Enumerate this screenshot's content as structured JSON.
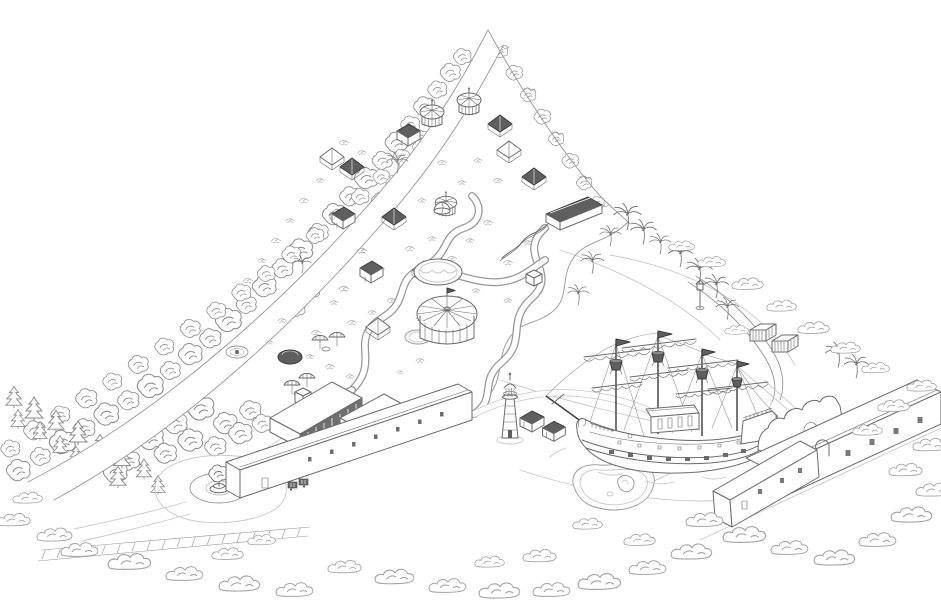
{
  "meta": {
    "description": "Hand-drawn isometric pen-and-ink map of a seaside amusement park with wooded mountain ridge, pirate ship, lighthouse and entrance plaza",
    "style": "monochrome line art",
    "background": "#ffffff"
  },
  "palette": {
    "ink_dark": "#3b3b3b",
    "ink": "#6b6b6b",
    "ink_light": "#979797",
    "ink_faint": "#c8c8c8",
    "paper": "#ffffff",
    "fill_dark": "#5f5f5f"
  },
  "landmarks": [
    {
      "id": "mountain-ridge-road",
      "center": [
        260,
        260
      ]
    },
    {
      "id": "amusement-park-grounds",
      "center": [
        400,
        240
      ]
    },
    {
      "id": "grand-carousel",
      "center": [
        447,
        330
      ]
    },
    {
      "id": "wave-pool",
      "center": [
        438,
        272
      ]
    },
    {
      "id": "water-slide-pavilion",
      "center": [
        575,
        215
      ]
    },
    {
      "id": "round-pavilions",
      "center": [
        450,
        145
      ]
    },
    {
      "id": "beach-lagoon",
      "center": [
        650,
        330
      ]
    },
    {
      "id": "pirate-ship",
      "center": [
        672,
        410
      ]
    },
    {
      "id": "lighthouse",
      "center": [
        510,
        410
      ]
    },
    {
      "id": "beach-huts",
      "center": [
        545,
        430
      ]
    },
    {
      "id": "storage-containers",
      "center": [
        765,
        345
      ]
    },
    {
      "id": "seaside-wall",
      "center": [
        800,
        428
      ]
    },
    {
      "id": "long-seafront-building",
      "center": [
        840,
        455
      ]
    },
    {
      "id": "entrance-hall",
      "center": [
        355,
        455
      ]
    },
    {
      "id": "entrance-pavilions",
      "center": [
        330,
        415
      ]
    },
    {
      "id": "fountain-roundabout",
      "center": [
        219,
        488
      ]
    },
    {
      "id": "parking-walkway",
      "center": [
        170,
        548
      ]
    },
    {
      "id": "mini-golf-pond",
      "center": [
        612,
        488
      ]
    }
  ],
  "decor": {
    "deciduous": [
      [
        18,
        472,
        1
      ],
      [
        40,
        458,
        0.85
      ],
      [
        62,
        444,
        1.1
      ],
      [
        84,
        430,
        0.9
      ],
      [
        106,
        416,
        1.05
      ],
      [
        128,
        402,
        0.9
      ],
      [
        150,
        388,
        1.1
      ],
      [
        170,
        372,
        0.85
      ],
      [
        190,
        356,
        1
      ],
      [
        210,
        340,
        0.9
      ],
      [
        228,
        322,
        1.1
      ],
      [
        246,
        306,
        0.85
      ],
      [
        264,
        288,
        1
      ],
      [
        282,
        270,
        0.9
      ],
      [
        300,
        252,
        1.05
      ],
      [
        318,
        234,
        0.85
      ],
      [
        334,
        216,
        1
      ],
      [
        350,
        198,
        0.9
      ],
      [
        366,
        180,
        1
      ],
      [
        382,
        162,
        0.85
      ],
      [
        396,
        144,
        0.95
      ],
      [
        410,
        126,
        0.8
      ],
      [
        424,
        108,
        0.9
      ],
      [
        437,
        91,
        0.8
      ],
      [
        450,
        74,
        0.85
      ],
      [
        462,
        58,
        0.75
      ],
      [
        10,
        450,
        0.8
      ],
      [
        34,
        432,
        0.9
      ],
      [
        60,
        416,
        0.8
      ],
      [
        86,
        400,
        0.9
      ],
      [
        112,
        383,
        0.8
      ],
      [
        138,
        366,
        0.85
      ],
      [
        164,
        348,
        0.8
      ],
      [
        190,
        330,
        0.85
      ],
      [
        216,
        312,
        0.8
      ],
      [
        241,
        294,
        0.8
      ],
      [
        266,
        275,
        0.75
      ],
      [
        291,
        256,
        0.8
      ],
      [
        315,
        237,
        0.75
      ],
      [
        338,
        218,
        0.7
      ],
      [
        360,
        198,
        0.75
      ],
      [
        381,
        178,
        0.7
      ],
      [
        401,
        158,
        0.7
      ],
      [
        420,
        138,
        0.65
      ],
      [
        352,
        238,
        0.75
      ],
      [
        338,
        256,
        0.8
      ],
      [
        324,
        274,
        0.75
      ],
      [
        310,
        292,
        0.8
      ],
      [
        296,
        310,
        0.75
      ],
      [
        366,
        220,
        0.7
      ],
      [
        380,
        202,
        0.75
      ],
      [
        394,
        184,
        0.7
      ],
      [
        407,
        166,
        0.7
      ],
      [
        420,
        148,
        0.65
      ],
      [
        500,
        52,
        0.65
      ],
      [
        514,
        74,
        0.7
      ],
      [
        528,
        96,
        0.65
      ],
      [
        542,
        118,
        0.7
      ],
      [
        556,
        140,
        0.65
      ],
      [
        570,
        162,
        0.7
      ],
      [
        584,
        184,
        0.65
      ],
      [
        597,
        204,
        0.6
      ],
      [
        150,
        440,
        1.1
      ],
      [
        175,
        425,
        1
      ],
      [
        200,
        410,
        1.15
      ],
      [
        225,
        425,
        1
      ],
      [
        250,
        412,
        0.9
      ],
      [
        165,
        455,
        0.95
      ],
      [
        190,
        442,
        1.05
      ],
      [
        215,
        448,
        0.9
      ],
      [
        240,
        435,
        1
      ],
      [
        262,
        425,
        0.85
      ],
      [
        128,
        462,
        0.95
      ],
      [
        115,
        474,
        1
      ]
    ],
    "conifers": [
      [
        14,
        398,
        0.9
      ],
      [
        34,
        410,
        1
      ],
      [
        56,
        422,
        0.9
      ],
      [
        78,
        434,
        1
      ],
      [
        100,
        446,
        0.9
      ],
      [
        122,
        458,
        0.95
      ],
      [
        144,
        470,
        0.85
      ],
      [
        60,
        446,
        0.8
      ],
      [
        90,
        462,
        0.85
      ],
      [
        118,
        478,
        0.9
      ],
      [
        40,
        432,
        0.8
      ],
      [
        18,
        420,
        0.8
      ],
      [
        158,
        486,
        0.8
      ],
      [
        76,
        456,
        0.75
      ]
    ],
    "palms": [
      [
        627,
        222,
        0.9
      ],
      [
        643,
        237,
        0.85
      ],
      [
        592,
        267,
        0.75
      ],
      [
        680,
        260,
        0.8
      ],
      [
        699,
        276,
        0.85
      ],
      [
        716,
        291,
        0.8
      ],
      [
        727,
        313,
        0.75
      ],
      [
        578,
        299,
        0.7
      ],
      [
        838,
        360,
        0.85
      ],
      [
        856,
        371,
        0.8
      ],
      [
        397,
        167,
        0.7
      ],
      [
        610,
        240,
        0.7
      ],
      [
        660,
        248,
        0.7
      ],
      [
        302,
        268,
        0.6
      ]
    ],
    "bushes": [
      [
        80,
        550,
        1
      ],
      [
        130,
        562,
        1.15
      ],
      [
        185,
        574,
        1
      ],
      [
        240,
        584,
        1.1
      ],
      [
        295,
        590,
        1
      ],
      [
        345,
        567,
        0.9
      ],
      [
        395,
        577,
        1.05
      ],
      [
        448,
        586,
        1
      ],
      [
        500,
        591,
        1.1
      ],
      [
        552,
        590,
        1
      ],
      [
        600,
        582,
        1.15
      ],
      [
        648,
        568,
        1
      ],
      [
        692,
        552,
        1.1
      ],
      [
        640,
        540,
        0.85
      ],
      [
        588,
        524,
        0.8
      ],
      [
        705,
        520,
        1
      ],
      [
        745,
        535,
        1.15
      ],
      [
        790,
        548,
        1
      ],
      [
        835,
        558,
        1.1
      ],
      [
        878,
        540,
        1
      ],
      [
        912,
        515,
        1.1
      ],
      [
        934,
        490,
        0.95
      ],
      [
        906,
        470,
        0.9
      ],
      [
        930,
        445,
        0.9
      ],
      [
        868,
        430,
        0.8
      ],
      [
        894,
        406,
        0.85
      ],
      [
        922,
        386,
        0.8
      ],
      [
        712,
        262,
        0.75
      ],
      [
        748,
        284,
        0.85
      ],
      [
        782,
        306,
        0.8
      ],
      [
        814,
        328,
        0.85
      ],
      [
        846,
        348,
        0.8
      ],
      [
        876,
        368,
        0.75
      ],
      [
        682,
        246,
        0.7
      ],
      [
        737,
        330,
        0.65
      ],
      [
        540,
        556,
        0.9
      ],
      [
        490,
        562,
        0.8
      ],
      [
        14,
        520,
        0.9
      ],
      [
        55,
        535,
        0.95
      ],
      [
        28,
        498,
        0.8
      ],
      [
        228,
        554,
        0.85
      ],
      [
        262,
        540,
        0.75
      ]
    ],
    "scrubs": [
      [
        362,
        250,
        0.9
      ],
      [
        380,
        268,
        0.8
      ],
      [
        344,
        288,
        0.9
      ],
      [
        410,
        248,
        0.8
      ],
      [
        432,
        238,
        0.7
      ],
      [
        452,
        258,
        0.8
      ],
      [
        470,
        240,
        0.7
      ],
      [
        488,
        222,
        0.8
      ],
      [
        462,
        182,
        0.7
      ],
      [
        442,
        162,
        0.8
      ],
      [
        478,
        160,
        0.7
      ],
      [
        498,
        180,
        0.8
      ],
      [
        422,
        200,
        0.7
      ],
      [
        392,
        300,
        0.8
      ],
      [
        372,
        312,
        0.7
      ],
      [
        352,
        322,
        0.8
      ],
      [
        334,
        302,
        0.7
      ],
      [
        316,
        332,
        0.8
      ],
      [
        420,
        318,
        0.7
      ],
      [
        458,
        298,
        0.8
      ],
      [
        476,
        290,
        0.7
      ],
      [
        508,
        262,
        0.8
      ],
      [
        528,
        242,
        0.7
      ],
      [
        362,
        152,
        0.7
      ],
      [
        344,
        142,
        0.8
      ],
      [
        320,
        180,
        0.7
      ],
      [
        304,
        200,
        0.8
      ],
      [
        290,
        220,
        0.7
      ],
      [
        276,
        240,
        0.8
      ],
      [
        262,
        260,
        0.7
      ],
      [
        248,
        280,
        0.8
      ],
      [
        310,
        356,
        0.7
      ],
      [
        330,
        366,
        0.8
      ],
      [
        350,
        376,
        0.7
      ],
      [
        508,
        300,
        0.7
      ],
      [
        520,
        320,
        0.6
      ],
      [
        420,
        360,
        0.7
      ],
      [
        400,
        372,
        0.6
      ],
      [
        282,
        320,
        0.7
      ],
      [
        270,
        342,
        0.6
      ]
    ]
  }
}
